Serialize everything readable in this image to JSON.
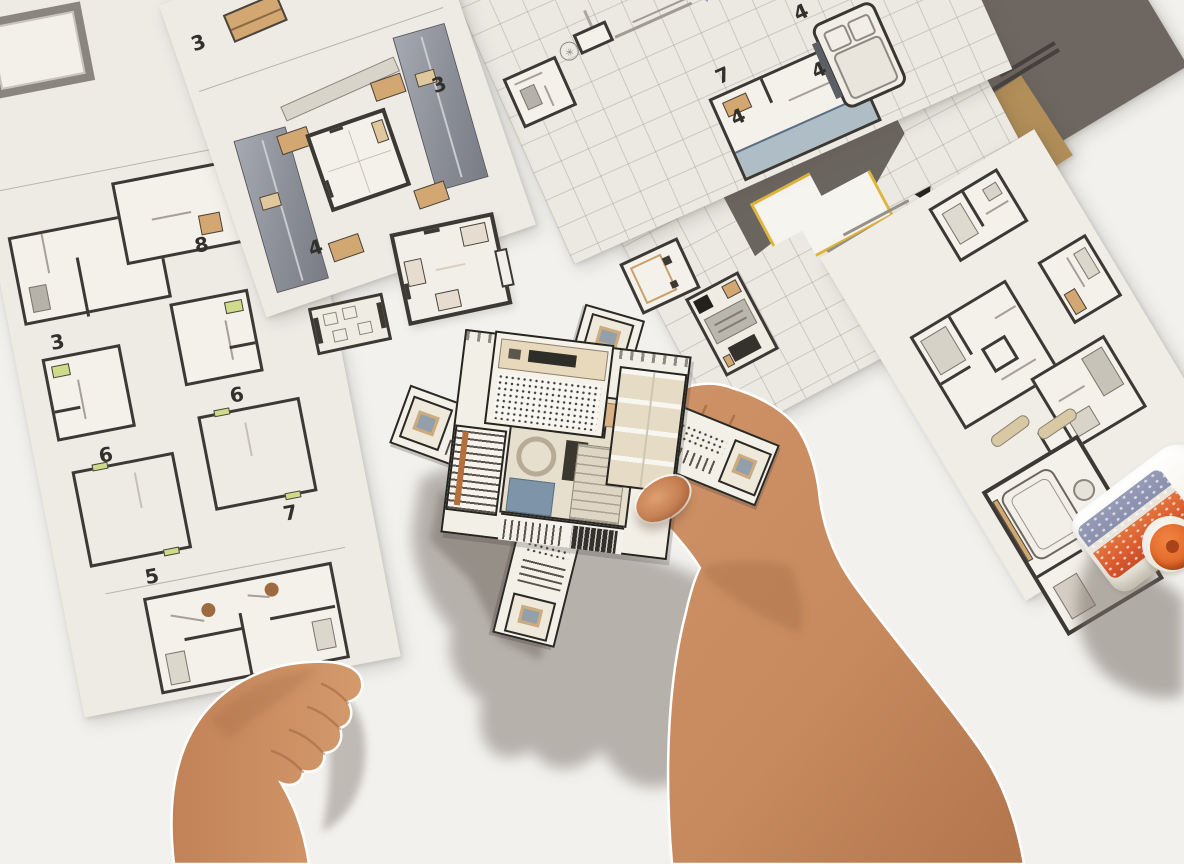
{
  "scene": {
    "type": "photograph",
    "description": "Top-down photo of two hands assembling a papercraft floor-plan building model on a white table, surrounded by cut-out instruction sheets and a glue bottle",
    "table_color": "#f2f1ee"
  },
  "sheets": {
    "left_strip": {
      "name": "tall instruction strip with numbered floor plans",
      "paper_color": "#edebe4",
      "step_numbers": [
        "3",
        "8",
        "6",
        "6",
        "5",
        "7"
      ]
    },
    "courtyard_sheet": {
      "name": "instruction sheet with courtyard building plan and furniture pieces",
      "paper_color": "#edebe4",
      "step_numbers": [
        "3",
        "4",
        "3"
      ]
    },
    "grid_sheet_top": {
      "name": "upside-down gridded instruction sheet with room plans and bed piece",
      "paper_color": "#ebe9e2",
      "step_numbers": [
        "7",
        "4",
        "4",
        "4"
      ]
    },
    "grid_sheet_bottom": {
      "name": "gridded sheet with dark roof pieces and yellow-outlined part",
      "paper_color": "#e9e7e0",
      "accent_yellow": "#e0b53a"
    },
    "right_plans_sheet": {
      "name": "sheet of bathroom and bedroom plan cut-outs",
      "paper_color": "#efede6"
    },
    "dark_card": {
      "name": "dark taupe cover card",
      "color": "#6e6660"
    },
    "kraft_card": {
      "name": "kraft cardboard sheet",
      "color": "#b28e58"
    }
  },
  "loose_pieces": {
    "count": 4,
    "names": [
      "furniture strip piece",
      "square bedroom piece",
      "small bathroom piece",
      "kitchenette piece"
    ]
  },
  "model": {
    "name": "partially assembled papercraft building with central courtyard and four diagonal wings",
    "colors": {
      "wood": "#d2a771",
      "rug_blue": "#7d94a9",
      "roof_gray": "#9297a0",
      "ink": "#2b2925",
      "paper": "#f3f0e8"
    }
  },
  "hands": {
    "right": "right hand holding the model, forearm reaching from bottom right",
    "left": "left hand resting flat on the table, bottom left",
    "skin_color": "#c8895e"
  },
  "glue_bottle": {
    "name": "white glue bottle with orange cap lying on its side, right edge",
    "cap_color": "#e66b2a",
    "label_orange": "#e2743c",
    "label_blue": "#969cb6"
  },
  "marks": {
    "warning_triangle": "black warning triangle with fine print",
    "logo_stamp": "small circular logo stamp",
    "black_tag": "black rounded label tag",
    "violet_triangle": "pale violet triangle mark"
  }
}
